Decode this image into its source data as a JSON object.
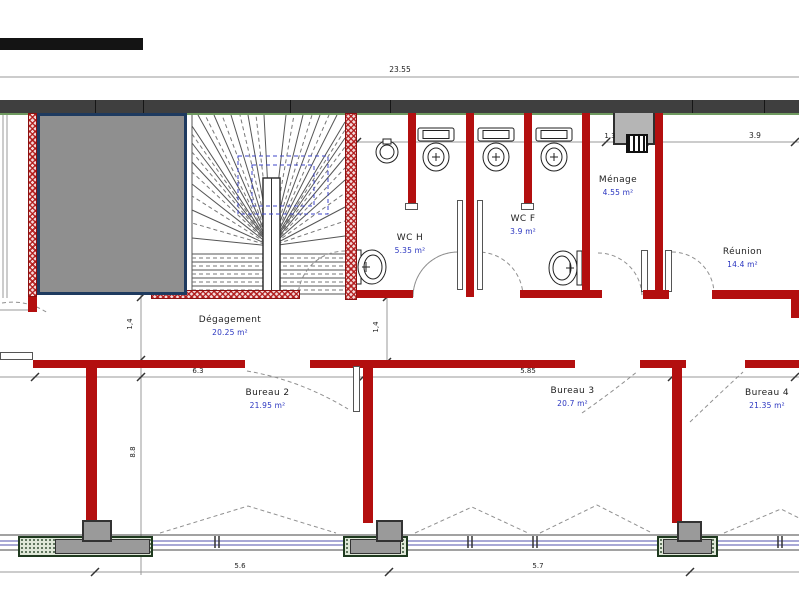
{
  "plan": {
    "rooms": [
      {
        "name": "Dégagement",
        "area": "20.25 m²"
      },
      {
        "name": "WC H",
        "area": "5.35 m²"
      },
      {
        "name": "WC F",
        "area": "3.9 m²"
      },
      {
        "name": "Ménage",
        "area": "4.55 m²"
      },
      {
        "name": "Réunion",
        "area": "14.4 m²"
      },
      {
        "name": "Bureau 2",
        "area": "21.95 m²"
      },
      {
        "name": "Bureau 3",
        "area": "20.7 m²"
      },
      {
        "name": "Bureau 4",
        "area": "21.35 m²"
      }
    ],
    "dims": {
      "overall_width": "23.55",
      "top_right": "3.9",
      "duct": "1,3",
      "corridor_height": "1,4",
      "wc_height": "1,4",
      "bay_left": "6.3",
      "bay_right": "5.85",
      "depth": "8.8",
      "window_left": "5.6",
      "window_right": "5.7"
    },
    "colors": {
      "wall_red": "#b30f0f",
      "exterior_band": "#3f3f3f",
      "shaft_fill": "#8f8f8f",
      "shaft_border_navy": "#1e3a5f",
      "sill_green": "#6f9a5f",
      "glazing_blue": "#8c8cc8",
      "area_text_blue": "#2a35c0",
      "stair_overlay_blue": "#3c46c8"
    }
  }
}
